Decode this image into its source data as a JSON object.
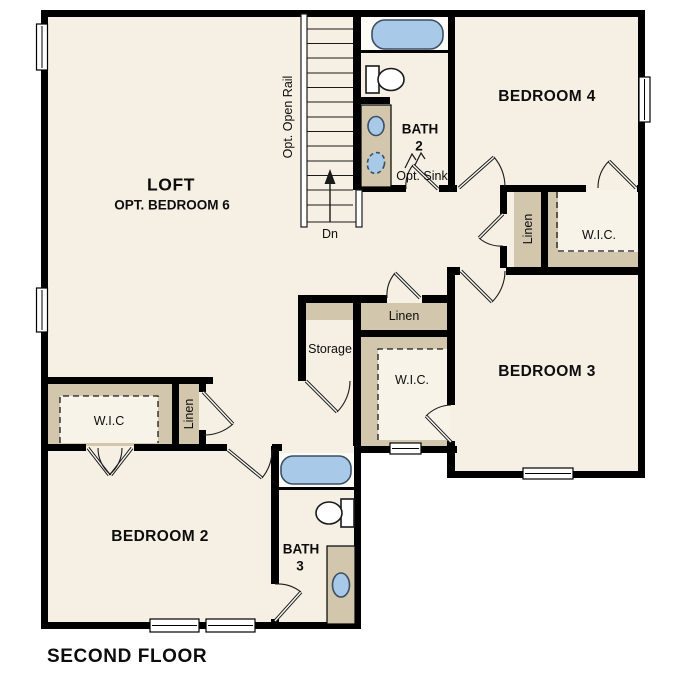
{
  "colors": {
    "paper": "#ffffff",
    "floor": "#f6f0e4",
    "wall": "#000000",
    "shelf": "#d2c6ac",
    "fixture": "#a9c9e9"
  },
  "title": "SECOND FLOOR",
  "labels": {
    "loft": "LOFT",
    "loft_opt": "OPT. BEDROOM 6",
    "bedroom4": "BEDROOM 4",
    "bedroom3": "BEDROOM 3",
    "bedroom2": "BEDROOM 2",
    "bath2_name": "BATH",
    "bath2_num": "2",
    "bath3_name": "BATH",
    "bath3_num": "3",
    "opt_sink": "Opt. Sink",
    "storage": "Storage",
    "linen": "Linen",
    "wic": "W.I.C.",
    "wic_bed2": "W.I.C",
    "opt_open_rail": "Opt. Open Rail",
    "down": "Dn"
  }
}
